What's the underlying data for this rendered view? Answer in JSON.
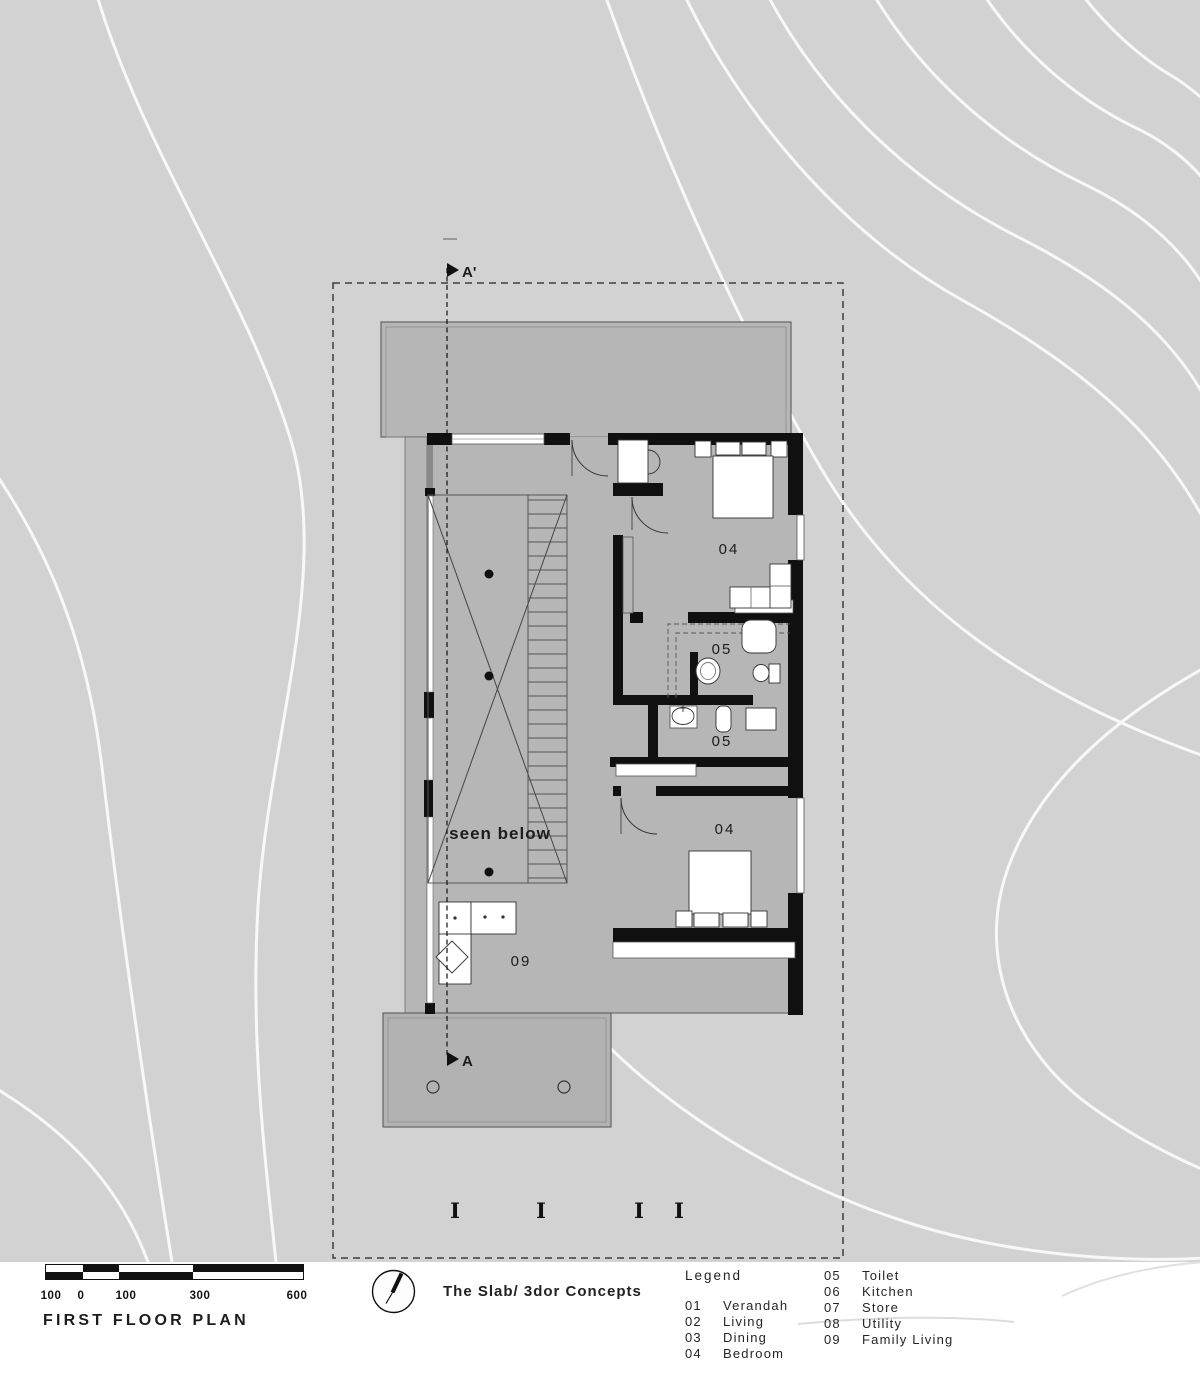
{
  "plan": {
    "section_labels": {
      "top": "A'",
      "bottom": "A"
    },
    "rooms": {
      "bedroom_top": "04",
      "toilet_top": "05",
      "toilet_bottom": "05",
      "bedroom_bottom": "04",
      "family_living": "09",
      "void_note": "seen below"
    },
    "column_markers": [
      "I",
      "I",
      "I",
      "I"
    ]
  },
  "title_block": {
    "drawing_title": "FIRST FLOOR PLAN",
    "project_title": "The Slab/ 3dor Concepts",
    "scale_labels": [
      "100",
      "0",
      "100",
      "300",
      "600"
    ]
  },
  "legend": {
    "heading": "Legend",
    "column1": [
      {
        "code": "01",
        "name": "Verandah"
      },
      {
        "code": "02",
        "name": "Living"
      },
      {
        "code": "03",
        "name": "Dining"
      },
      {
        "code": "04",
        "name": "Bedroom"
      }
    ],
    "column2": [
      {
        "code": "05",
        "name": "Toilet"
      },
      {
        "code": "06",
        "name": "Kitchen"
      },
      {
        "code": "07",
        "name": "Store"
      },
      {
        "code": "08",
        "name": "Utility"
      },
      {
        "code": "09",
        "name": "Family Living"
      }
    ]
  },
  "colors": {
    "site": "#d2d2d2",
    "slab": "#b6b6b6",
    "terrace": "#b2b2b2",
    "wall": "#101010",
    "contour": "#f8f8f8",
    "paper": "#ffffff"
  }
}
